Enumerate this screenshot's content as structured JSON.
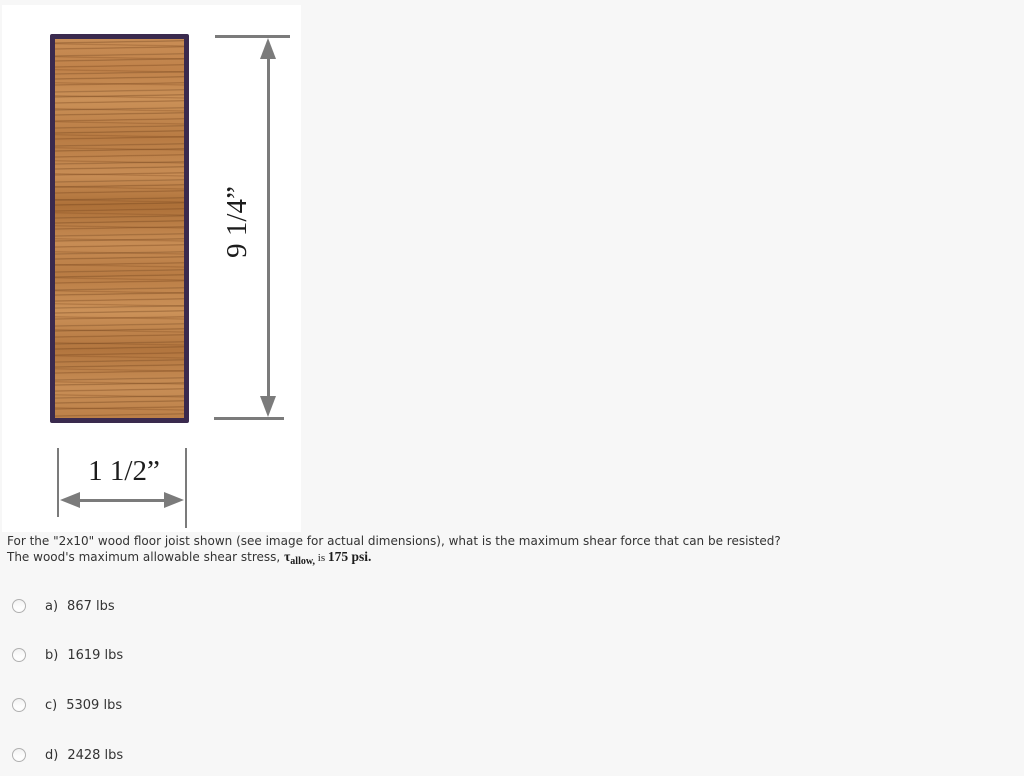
{
  "page": {
    "background_color": "#f7f7f7",
    "panel_color": "#ffffff"
  },
  "figure": {
    "joist_border_color": "#3a2a4e",
    "wood_base_color": "#c68a52",
    "dimension_color": "#7b7b7b",
    "height_label": "9 1/4”",
    "width_label": "1 1/2”"
  },
  "question": {
    "line1": "For the \"2x10\" wood floor joist shown (see image for actual dimensions), what is the maximum shear force that can be resisted?",
    "line2_prefix": "The wood's maximum allowable shear stress, ",
    "tau_symbol": "τ",
    "tau_subscript": "allow,",
    "connector": " is ",
    "stress_value": "175 psi."
  },
  "options": [
    {
      "key": "a)",
      "value": "867 lbs"
    },
    {
      "key": "b)",
      "value": "1619 lbs"
    },
    {
      "key": "c)",
      "value": "5309 lbs"
    },
    {
      "key": "d)",
      "value": "2428 lbs"
    }
  ]
}
